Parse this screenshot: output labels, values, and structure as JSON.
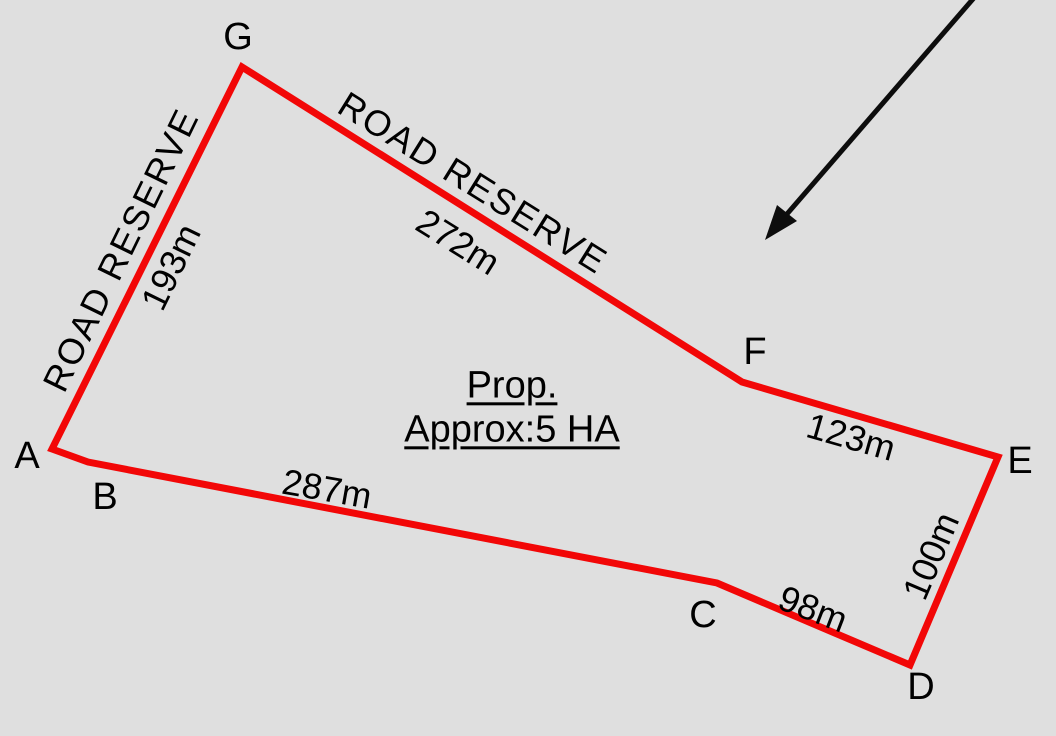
{
  "survey_plot": {
    "area_label": {
      "line1": "Prop.",
      "line2": "Approx:5 HA"
    },
    "vertices": {
      "A": "A",
      "B": "B",
      "C": "C",
      "D": "D",
      "E": "E",
      "F": "F",
      "G": "G"
    },
    "edges": {
      "GA": {
        "road_name": "ROAD RESERVE",
        "length": "193m"
      },
      "GF": {
        "road_name": "ROAD RESERVE",
        "length": "272m"
      },
      "FE": {
        "length": "123m"
      },
      "BC": {
        "length": "287m"
      },
      "CD": {
        "length": "98m"
      },
      "DE": {
        "length": "100m"
      }
    },
    "icons": {
      "north_arrow": "southwest-pointing-arrow"
    },
    "colors": {
      "boundary_red": "#f20707",
      "background_gray": "#dfdfdf",
      "text_black": "#000000",
      "arrow_black": "#0d0d0d"
    }
  }
}
